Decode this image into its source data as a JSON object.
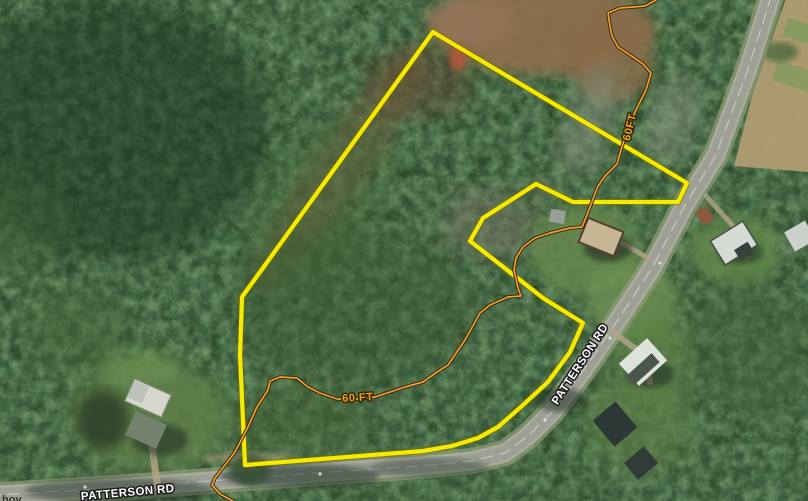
{
  "map": {
    "view": "satellite-parcel-view",
    "labels": {
      "road_name_diagonal": "PATTERSON RD",
      "road_name_bottom": "PATTERSON RD",
      "row_width_top": "60FT",
      "row_width_mid": "60 FT",
      "partial_text_corner": "hov"
    },
    "colors": {
      "parcel_boundary": "#f6ea00",
      "right_of_way_line": "#f1a333",
      "row_label_fill": "#eea41c",
      "road_label_fill": "#ffffff"
    },
    "parcel_boundary_points": "433,32 687,183 678,202 573,202 536,184 483,218 470,241 543,298 583,323 570,352 548,382 523,405 498,427 478,438 452,446 423,451 245,465 240,355 242,297",
    "right_of_way_points": "656,0 645,6 620,8 608,13 610,26 612,36 618,47 630,55 643,64 651,73 646,90 636,110 628,128 621,150 617,164 605,176 598,186 587,215 582,227 570,228 550,233 535,238 523,247 516,258 514,270 518,288 521,296 508,297 490,305 480,313 465,340 448,365 437,372 423,382 405,387 390,392 375,397 360,399 337,399 320,393 308,387 297,378 280,377 270,381 268,390 257,407 248,427 235,452 215,478 212,485 220,494 233,501",
    "road_path": "M 772,-6 L 747,72 L 716,155 L 685,205 L 652,268 L 618,320 L 585,368 L 552,412 L 528,436 L 505,453 L 472,461 L 420,466 L 330,472 L 235,479 L 130,487 L 0,495"
  }
}
